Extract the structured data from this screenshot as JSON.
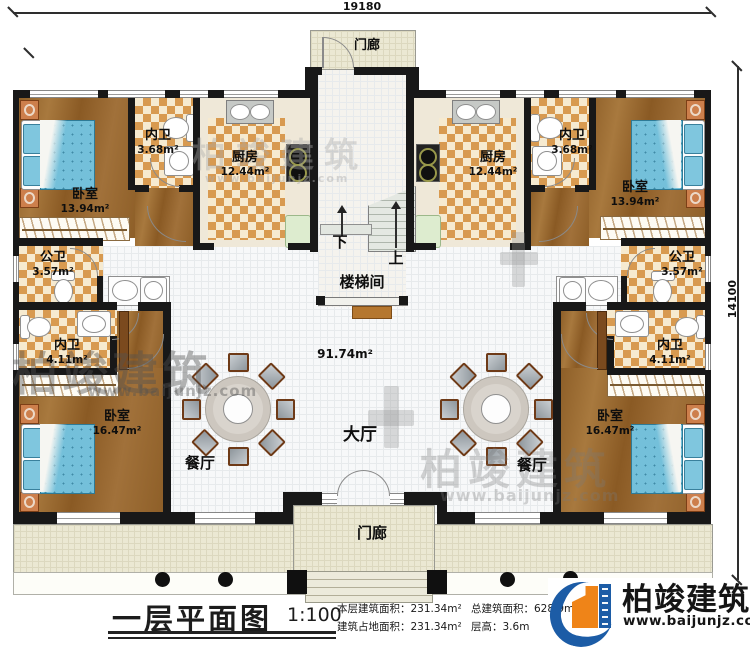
{
  "title_block": {
    "title": "一层平面图",
    "scale": "1:100"
  },
  "dimensions": {
    "width_label": "19180",
    "height_label": "14100"
  },
  "rooms": {
    "porch_top": {
      "name": "门廊"
    },
    "porch_bottom": {
      "name": "门廊"
    },
    "stairwell": {
      "name": "楼梯间"
    },
    "hall": {
      "name": "大厅",
      "area": "91.74m²"
    },
    "dining_left": {
      "name": "餐厅"
    },
    "dining_right": {
      "name": "餐厅"
    },
    "kitchen_left": {
      "name": "厨房",
      "area": "12.44m²"
    },
    "kitchen_right": {
      "name": "厨房",
      "area": "12.44m²"
    },
    "bedroom_top_left": {
      "name": "卧室",
      "area": "13.94m²"
    },
    "bedroom_top_right": {
      "name": "卧室",
      "area": "13.94m²"
    },
    "bedroom_bottom_left": {
      "name": "卧室",
      "area": "16.47m²"
    },
    "bedroom_bottom_right": {
      "name": "卧室",
      "area": "16.47m²"
    },
    "ensuite_top_left": {
      "name": "内卫",
      "area": "3.68m²"
    },
    "ensuite_top_right": {
      "name": "内卫",
      "area": "3.68m²"
    },
    "ensuite_bottom_left": {
      "name": "内卫",
      "area": "4.11m²"
    },
    "ensuite_bottom_right": {
      "name": "内卫",
      "area": "4.11m²"
    },
    "bath_public_left": {
      "name": "公卫",
      "area": "3.57m²"
    },
    "bath_public_right": {
      "name": "公卫",
      "area": "3.57m²"
    }
  },
  "stairs": {
    "down": "下",
    "up": "上"
  },
  "stats": {
    "floor_area_label": "本层建筑面积：",
    "floor_area_value": "231.34m²",
    "total_area_label": "总建筑面积：",
    "total_area_value": "628.9m²",
    "footprint_label": "建筑占地面积：",
    "footprint_value": "231.34m²",
    "height_label": "层高：",
    "height_value": "3.6m"
  },
  "brand": {
    "name": "柏竣建筑",
    "url": "www.baijunjz.com"
  },
  "watermark": {
    "text": "柏竣建筑",
    "url": "www.baijunjz.com"
  }
}
